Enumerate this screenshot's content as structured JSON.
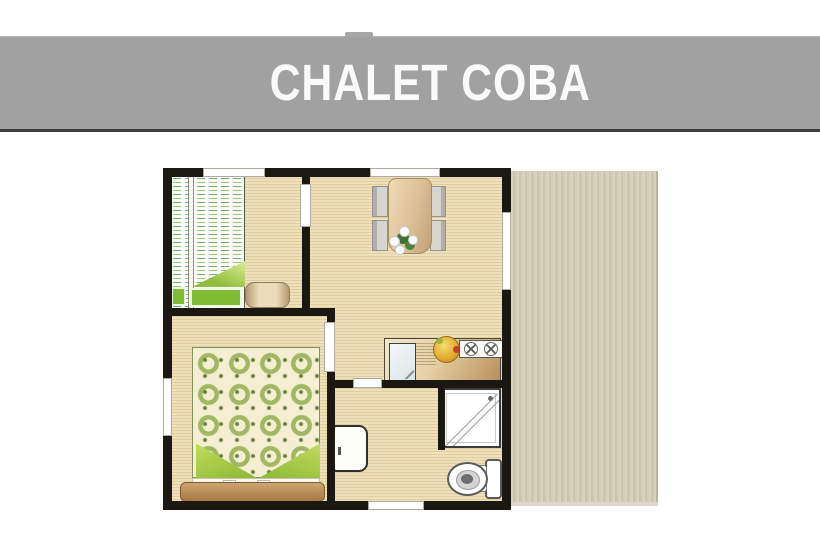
{
  "title_bar": {
    "title": "CHALET COBA"
  },
  "colors": {
    "banner_bg": "#a1a1a1",
    "banner_border": "#3f3f3f",
    "banner_text": "#fafafa",
    "wall": "#1b1713",
    "floor_base": "#eee0ba",
    "floor_line": "#e1cda0",
    "terrace_light": "#d9d3c0",
    "terrace_dark": "#cbc4ae",
    "bed_green": "#8cbe3f",
    "wood_brown": "#b98f5c"
  },
  "floorplan": {
    "name": "chalet-coba-floor-plan",
    "icons": [
      "bunk-bed-icon",
      "blanket-icon",
      "pillow-icon",
      "ottoman-icon",
      "double-bed-icon",
      "headboard-icon",
      "dining-table-icon",
      "chair-icon",
      "flowers-icon",
      "kitchen-counter-icon",
      "sink-icon",
      "faucet-icon",
      "drainboard-icon",
      "fruit-bowl-icon",
      "stove-icon",
      "burner-icon",
      "cabinet-icon",
      "shower-icon",
      "shower-drain-icon",
      "toilet-icon",
      "window-icon",
      "door-opening-icon",
      "terrace-deck-icon",
      "wall"
    ]
  }
}
